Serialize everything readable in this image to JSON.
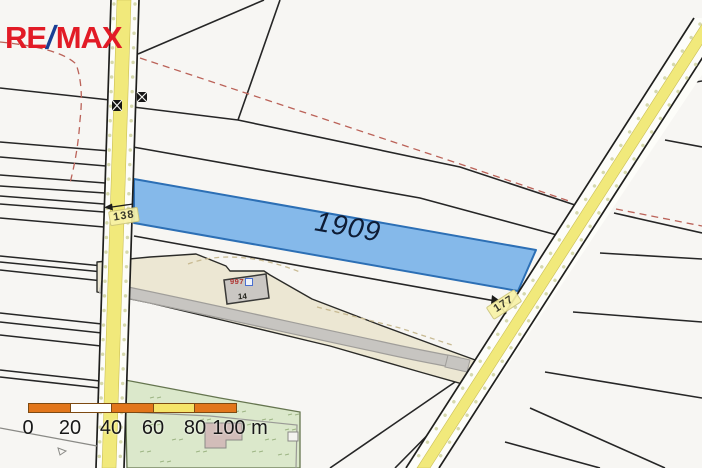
{
  "branding": {
    "re": "RE",
    "slash": "/",
    "max": "MAX"
  },
  "map": {
    "highlighted_parcel": {
      "label": "1909"
    },
    "road_labels": {
      "left": "138",
      "right": "177"
    },
    "building": {
      "house_number": "997",
      "parcel_number": "14"
    }
  },
  "scale_bar": {
    "ticks": [
      "0",
      "20",
      "40",
      "60",
      "80"
    ],
    "end_label": "100 m"
  },
  "colors": {
    "parcel_fill": "#85b9ea",
    "parcel_stroke": "#2c6fb5",
    "road_yellow": "#f1e97b",
    "scale_orange": "#e2761b",
    "scale_yellow": "#f5e469",
    "remax_red": "#e21b26",
    "remax_blue": "#1a3f94",
    "green_area": "#dbe8cb",
    "corridor_beige": "#ece7d3"
  }
}
